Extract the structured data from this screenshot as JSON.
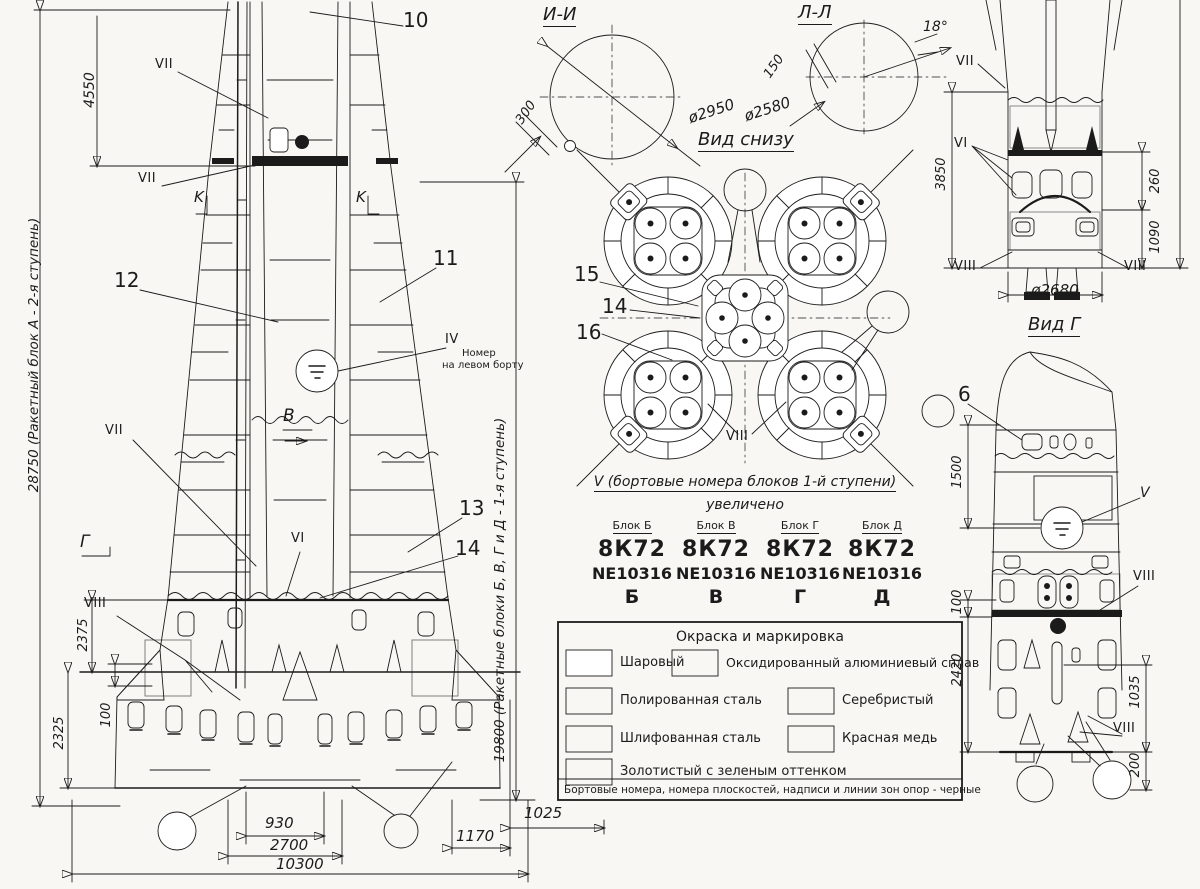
{
  "main_view": {
    "dim_total": "28750 (Ракетный блок А - 2-я ступень)",
    "dim_4550": "4550",
    "dim_stage1": "19800 (Ракетные блоки Б, В, Г и Д - 1-я ступень)",
    "dim_2375": "2375",
    "dim_2325": "2325",
    "dim_100": "100",
    "dim_930": "930",
    "dim_2700": "2700",
    "dim_10300": "10300",
    "dim_1170": "1170",
    "dim_1025": "1025",
    "callout_10": "10",
    "callout_11": "11",
    "callout_12": "12",
    "callout_13": "13",
    "callout_14": "14",
    "label_vii": "VII",
    "label_vi": "VI",
    "label_viii": "VIII",
    "label_iv": "IV",
    "iv_note_line1": "Номер",
    "iv_note_line2": "на левом борту",
    "marker_k": "K",
    "marker_v": "В",
    "marker_g": "Г"
  },
  "section_ii": {
    "title": "И-И",
    "diameter": "ø2950",
    "dim_300": "300"
  },
  "section_ll": {
    "title": "Л-Л",
    "diameter": "ø2580",
    "dim_150": "150",
    "angle": "18°"
  },
  "bottom_view": {
    "title": "Вид снизу",
    "callout_15": "15",
    "callout_14": "14",
    "callout_16": "16",
    "label_viii": "VIII"
  },
  "board_numbers": {
    "caption": "V (бортовые номера блоков 1-й ступени)",
    "subcaption": "увеличено",
    "columns": [
      {
        "header": "Блок Б",
        "code": "8К72",
        "number": "NE10316",
        "letter": "Б"
      },
      {
        "header": "Блок В",
        "code": "8К72",
        "number": "NE10316",
        "letter": "В"
      },
      {
        "header": "Блок Г",
        "code": "8К72",
        "number": "NE10316",
        "letter": "Г"
      },
      {
        "header": "Блок Д",
        "code": "8К72",
        "number": "NE10316",
        "letter": "Д"
      }
    ]
  },
  "legend": {
    "title": "Окраска и маркировка",
    "items": [
      {
        "label": "Шаровый",
        "pattern": "white"
      },
      {
        "label": "Оксидированный алюминиевый сплав",
        "pattern": "oxide"
      },
      {
        "label": "Полированная сталь",
        "pattern": "polished-steel"
      },
      {
        "label": "Серебристый",
        "pattern": "silver"
      },
      {
        "label": "Шлифованная сталь",
        "pattern": "ground-steel"
      },
      {
        "label": "Красная медь",
        "pattern": "red-copper"
      },
      {
        "label": "Золотистый с зеленым оттенком",
        "pattern": "gold-green"
      }
    ],
    "note": "Бортовые номера, номера плоскостей, надписи и линии зон опор - черные"
  },
  "rear_view": {
    "label_vii": "VII",
    "label_vi": "VI",
    "label_viii_left": "VIII",
    "label_viii_right": "VIII",
    "dim_3850": "3850",
    "dim_260": "260",
    "dim_1090": "1090",
    "diameter": "ø2680"
  },
  "view_g": {
    "title": "Вид Г",
    "callout_6": "6",
    "label_v": "V",
    "label_viii_top": "VIII",
    "label_viii_bottom": "VIII",
    "dim_1500": "1500",
    "dim_100": "100",
    "dim_2420": "2420",
    "dim_1035": "1035",
    "dim_200": "200"
  }
}
